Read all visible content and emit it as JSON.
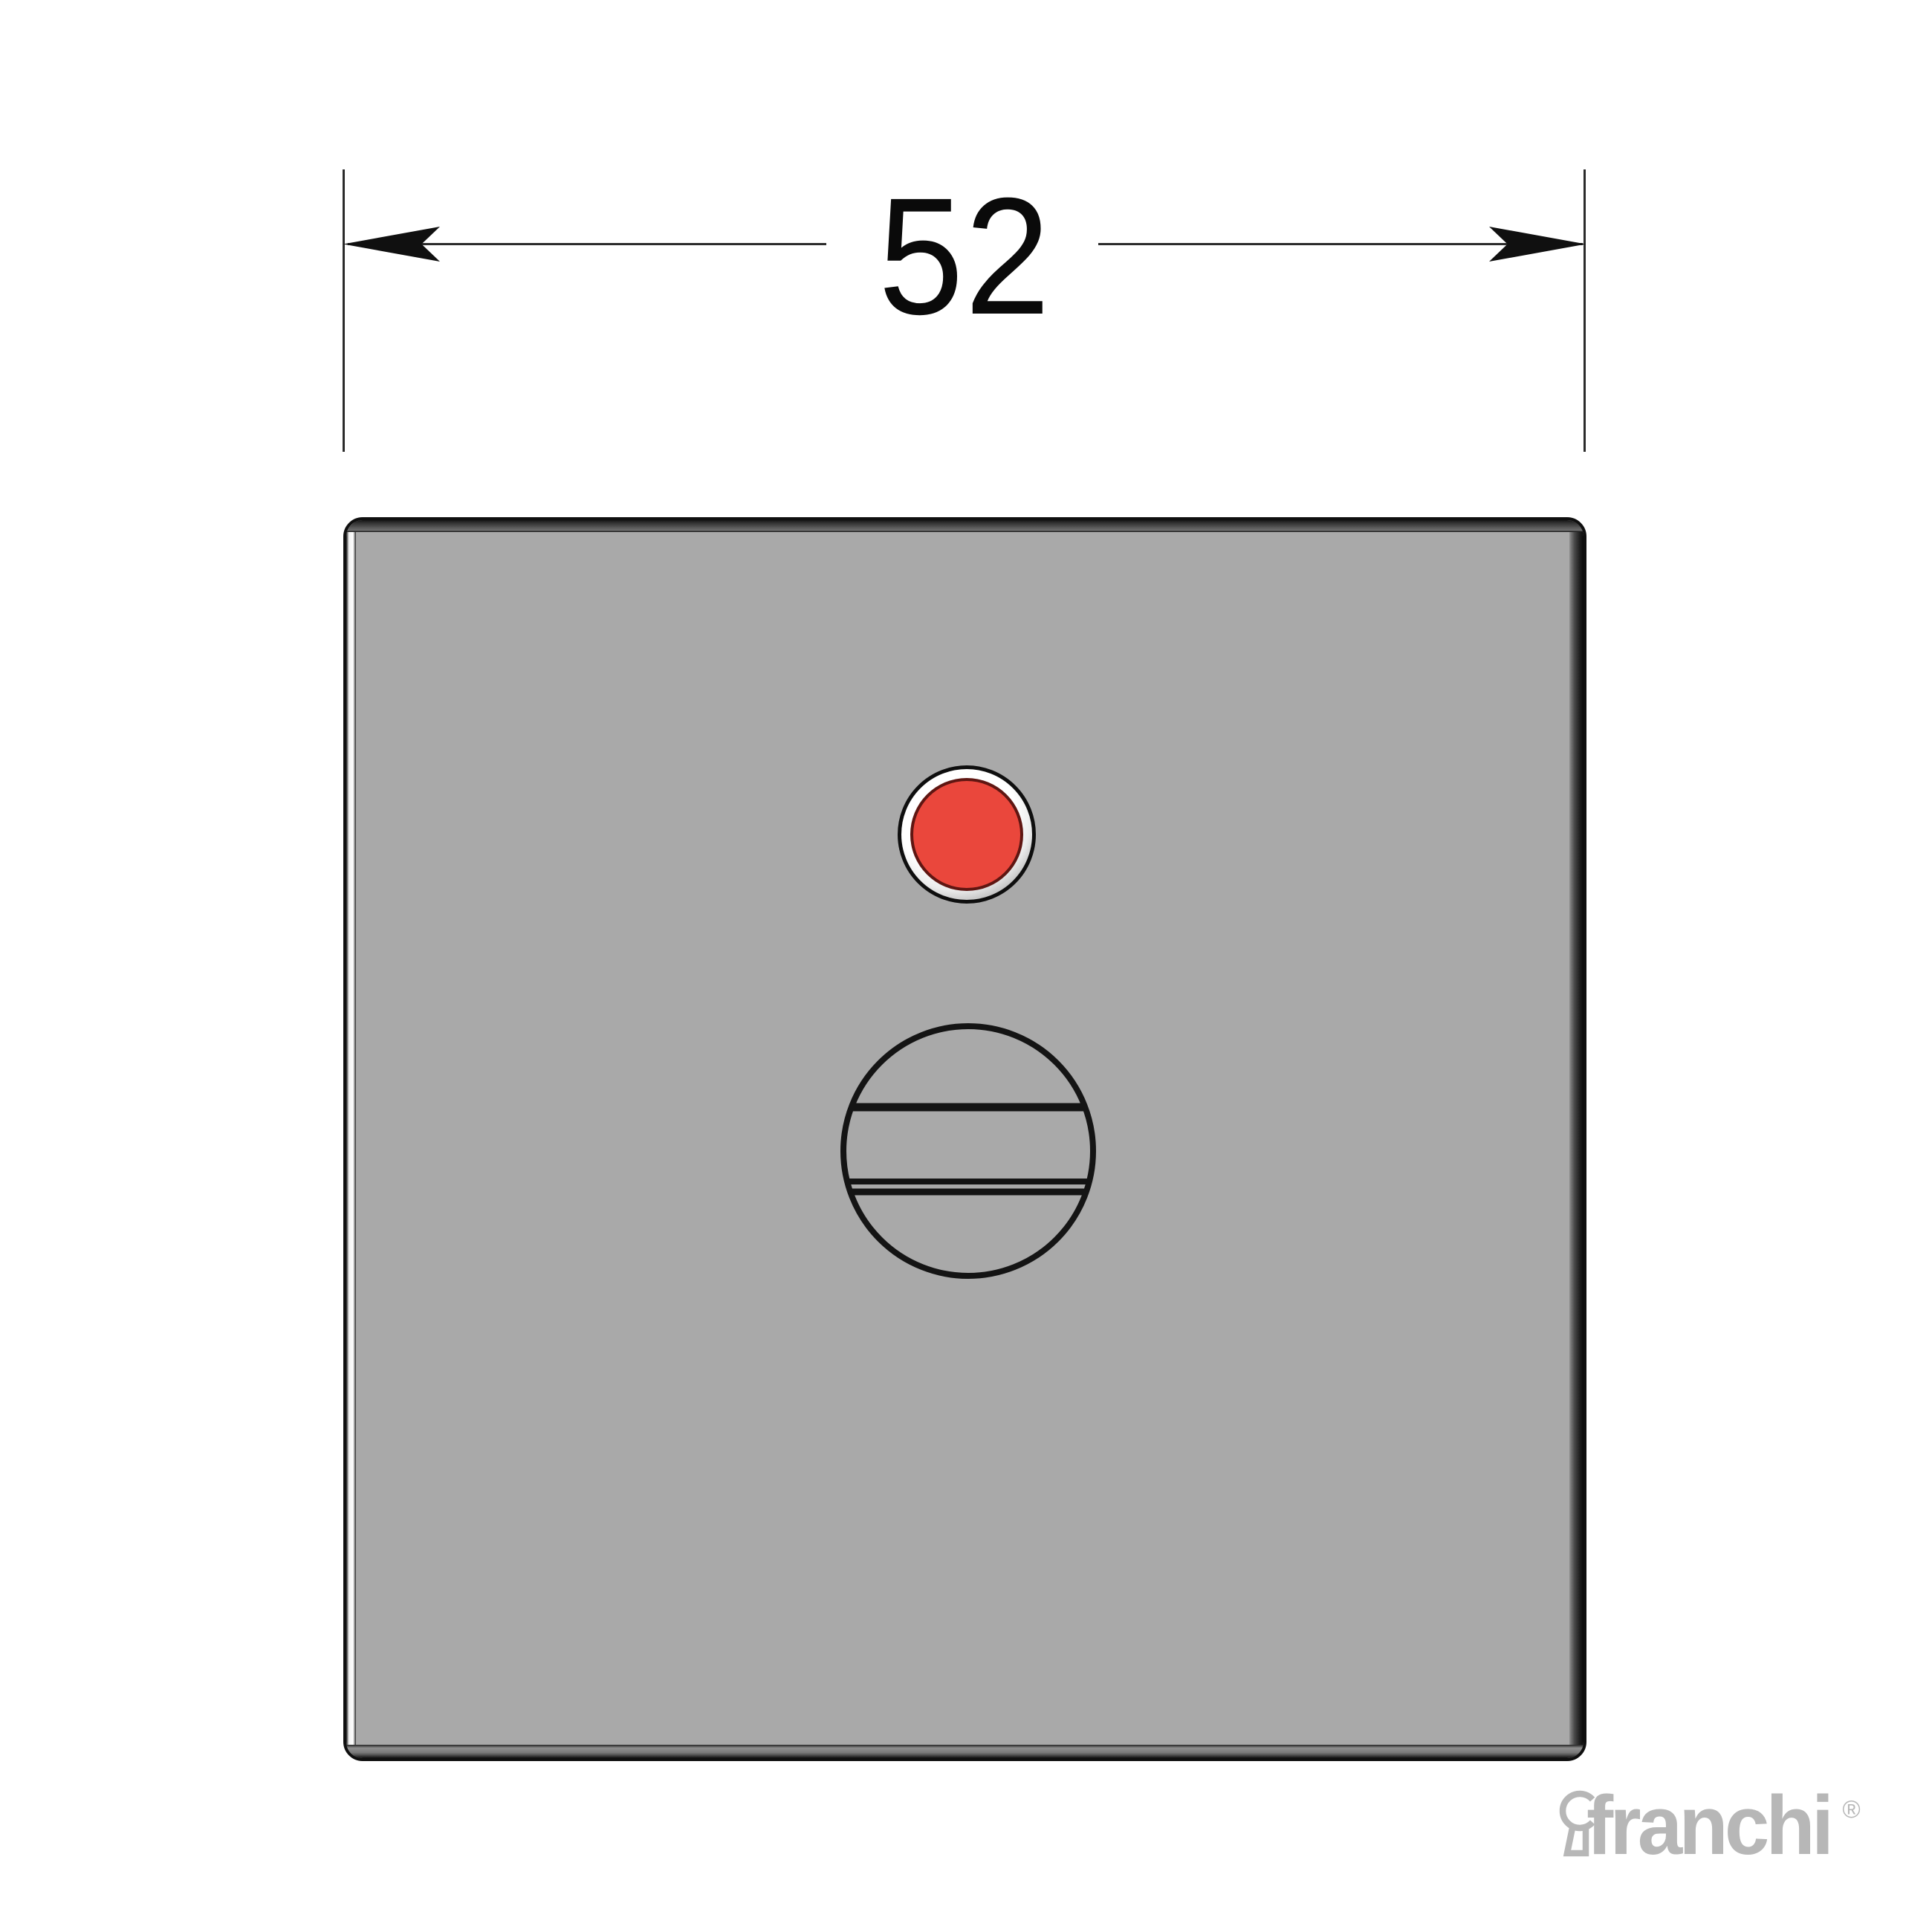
{
  "dimension": {
    "value": "52"
  },
  "brand": {
    "name": "franchi",
    "registered": "®"
  },
  "colors": {
    "background": "#ffffff",
    "plate_face": "#a9a9a9",
    "indicator_red": "#ea473c",
    "line": "#2b2b2b",
    "logo_gray": "#b7b7b7"
  }
}
